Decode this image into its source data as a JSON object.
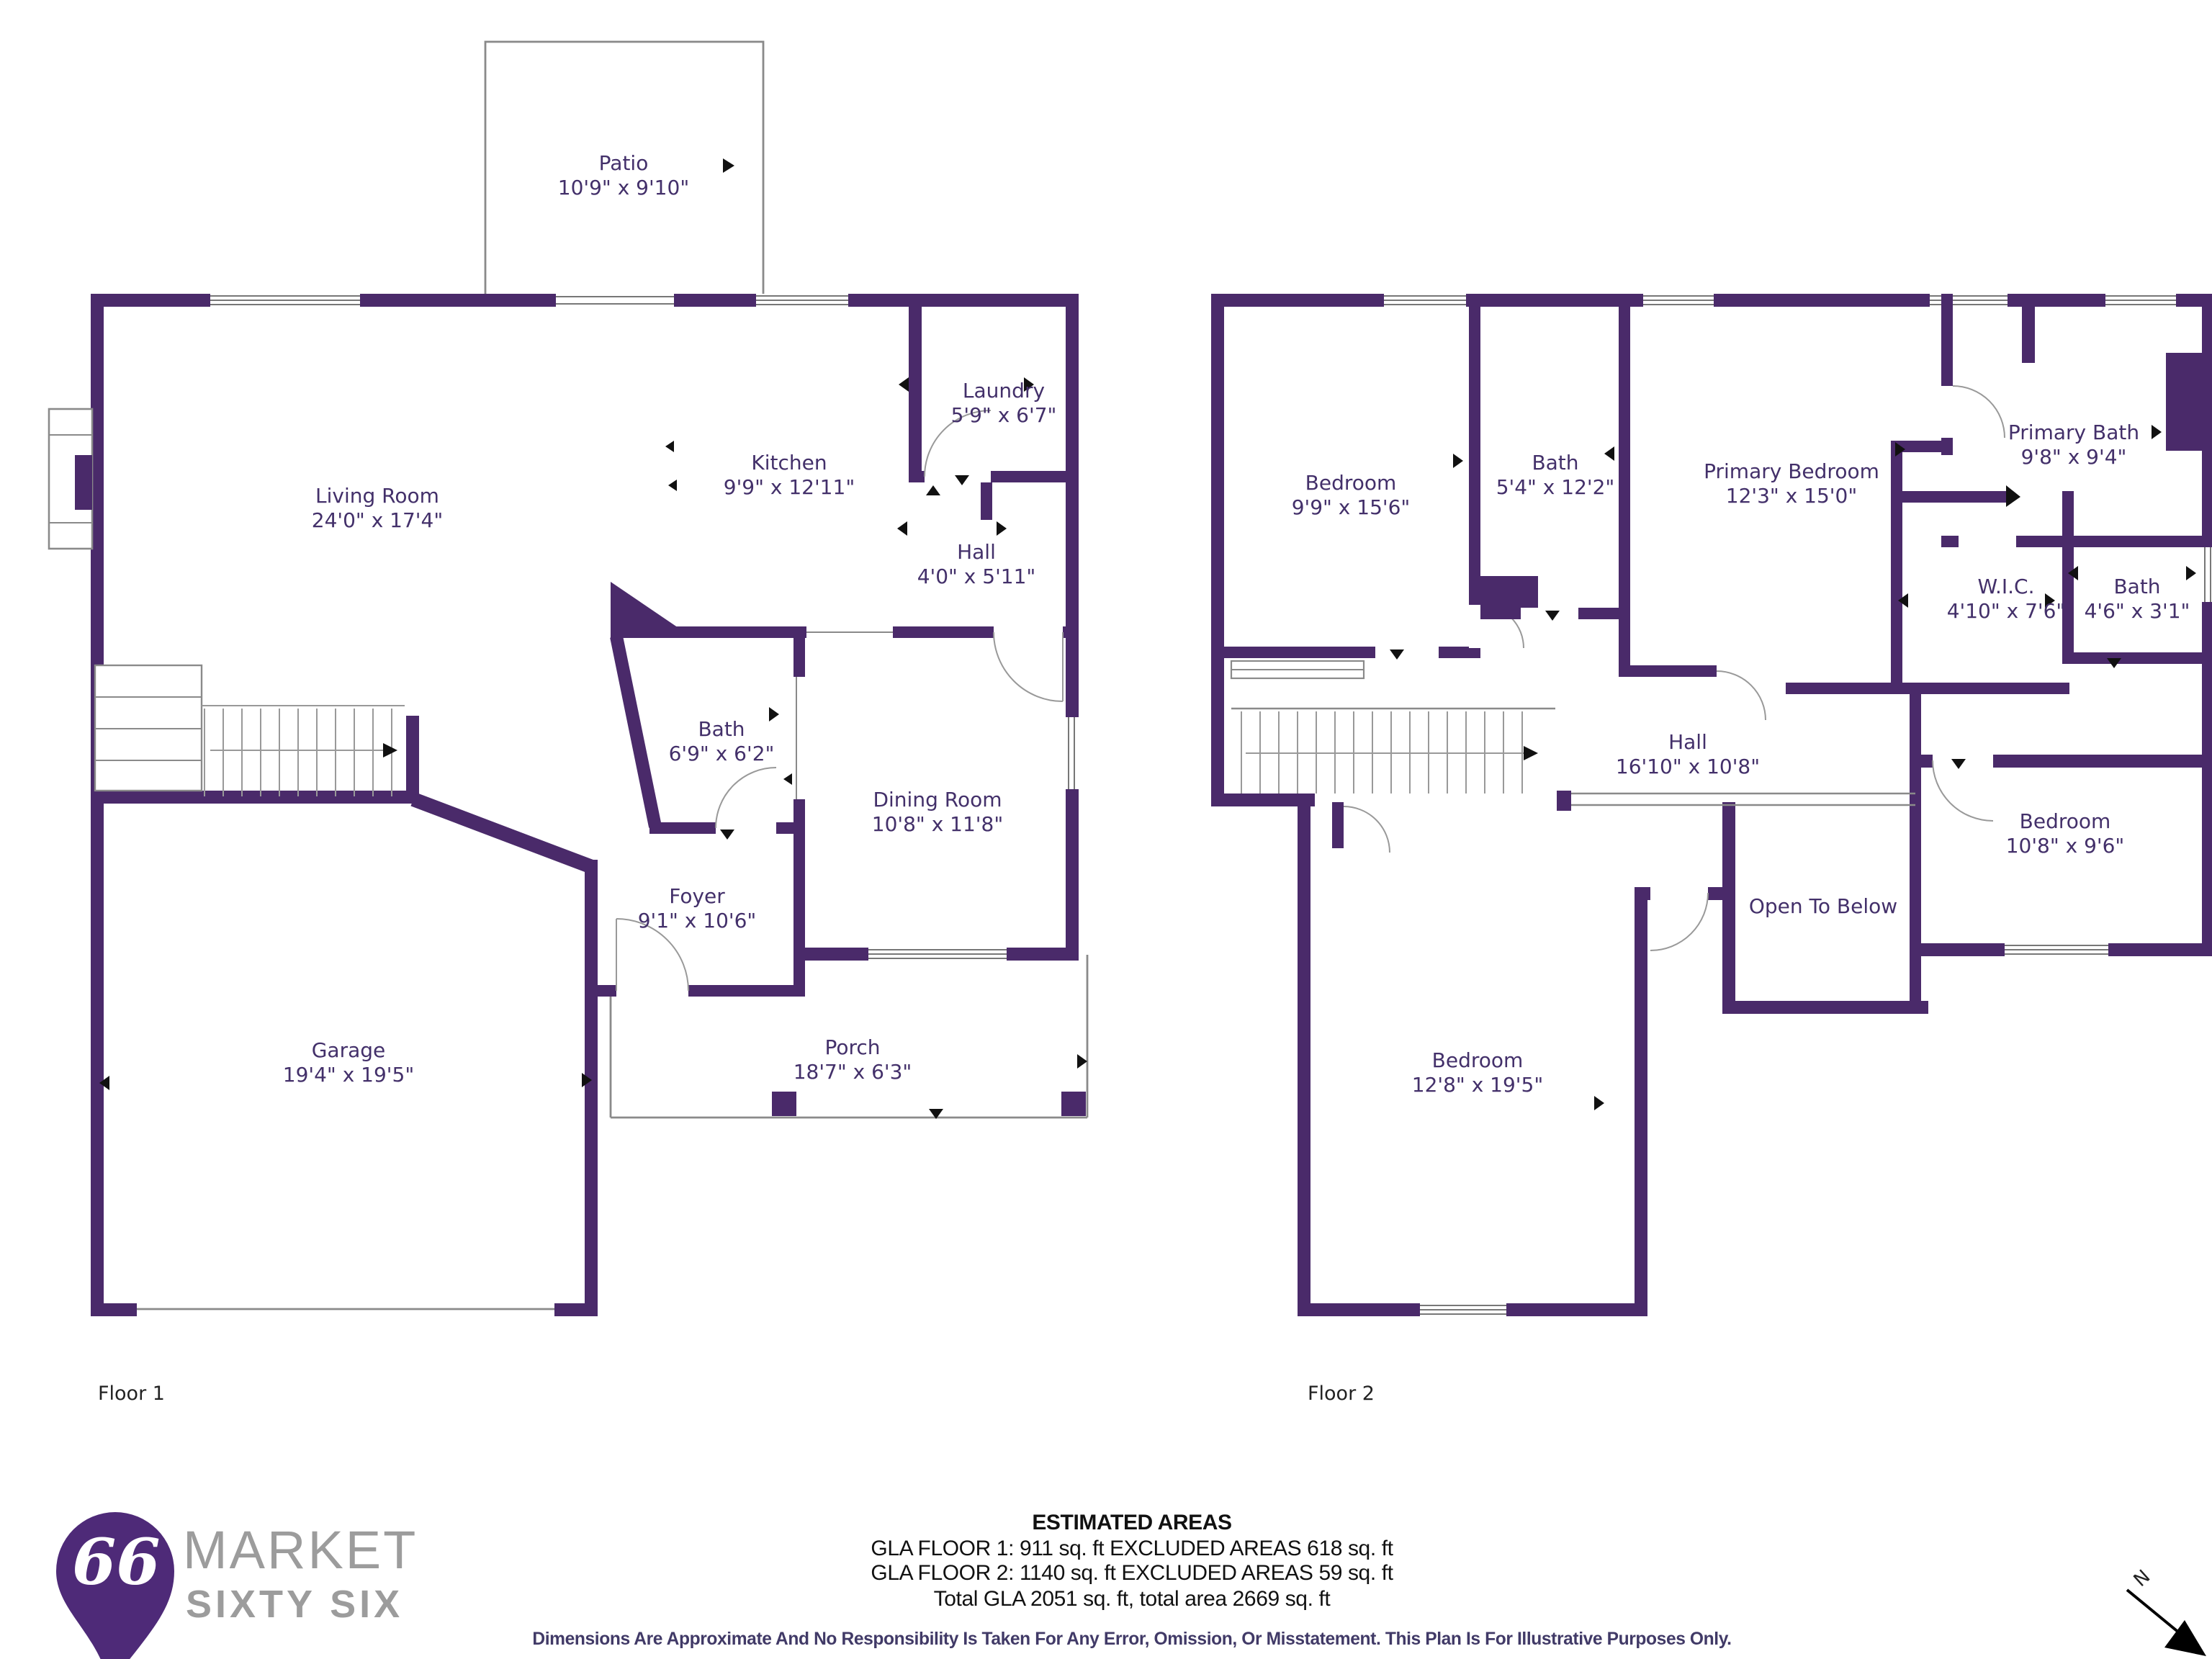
{
  "floor1": {
    "caption": "Floor 1",
    "rooms": [
      {
        "name": "Patio",
        "dims": "10'9\" x 9'10\""
      },
      {
        "name": "Living Room",
        "dims": "24'0\" x 17'4\""
      },
      {
        "name": "Kitchen",
        "dims": "9'9\" x 12'11\""
      },
      {
        "name": "Laundry",
        "dims": "5'9\" x 6'7\""
      },
      {
        "name": "Hall",
        "dims": "4'0\" x 5'11\""
      },
      {
        "name": "Bath",
        "dims": "6'9\" x 6'2\""
      },
      {
        "name": "Dining Room",
        "dims": "10'8\" x 11'8\""
      },
      {
        "name": "Foyer",
        "dims": "9'1\" x 10'6\""
      },
      {
        "name": "Garage",
        "dims": "19'4\" x 19'5\""
      },
      {
        "name": "Porch",
        "dims": "18'7\" x 6'3\""
      }
    ]
  },
  "floor2": {
    "caption": "Floor 2",
    "rooms": [
      {
        "name": "Bedroom",
        "dims": "9'9\" x 15'6\""
      },
      {
        "name": "Bath",
        "dims": "5'4\" x 12'2\""
      },
      {
        "name": "Primary Bedroom",
        "dims": "12'3\" x 15'0\""
      },
      {
        "name": "Primary Bath",
        "dims": "9'8\" x 9'4\""
      },
      {
        "name": "W.I.C.",
        "dims": "4'10\" x 7'6\""
      },
      {
        "name": "Bath",
        "dims": "4'6\" x 3'1\""
      },
      {
        "name": "Hall",
        "dims": "16'10\" x 10'8\""
      },
      {
        "name": "Bedroom",
        "dims": "10'8\" x 9'6\""
      },
      {
        "name": "Open To Below",
        "dims": ""
      },
      {
        "name": "Bedroom",
        "dims": "12'8\" x 19'5\""
      }
    ]
  },
  "footer": {
    "title": "ESTIMATED AREAS",
    "line1": "GLA FLOOR 1: 911 sq. ft EXCLUDED AREAS 618 sq. ft",
    "line2": "GLA FLOOR 2: 1140 sq. ft EXCLUDED AREAS 59 sq. ft",
    "line3": "Total GLA 2051 sq. ft, total area 2669 sq. ft",
    "disclaimer": "Dimensions Are Approximate And No Responsibility Is Taken For Any Error, Omission, Or Misstatement. This Plan Is For Illustrative Purposes Only."
  },
  "logo": {
    "badge": "66",
    "brand_line1": "MARKET",
    "brand_line2": "SIXTY SIX"
  },
  "compass": {
    "north_label": "N"
  },
  "colors": {
    "wall": "#4a2a6a",
    "label_text": "#43306a",
    "thin_line": "#8a8a8a",
    "disclaimer_text": "#413a67",
    "logo_gray": "#9c9c9c",
    "logo_purple": "#4e2a78"
  }
}
